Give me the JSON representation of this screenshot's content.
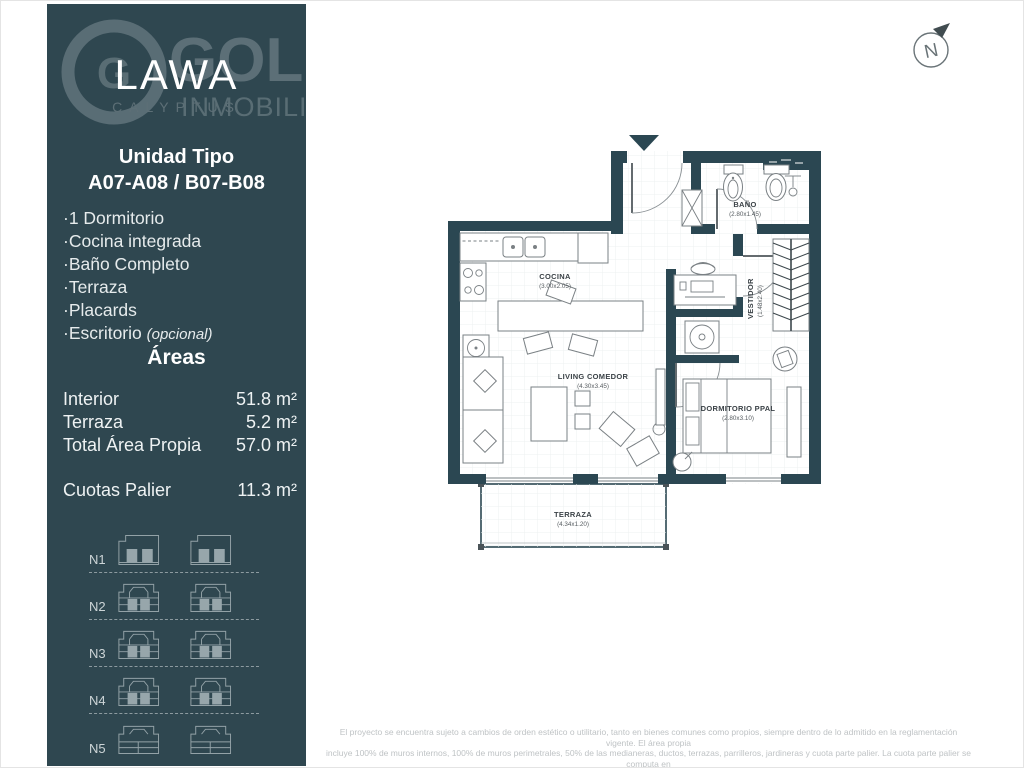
{
  "brand": {
    "logo_main": "LAWA",
    "logo_sub": "CALYPTUS",
    "watermark_initial": "G",
    "watermark_top": "GOLD",
    "watermark_bottom": "INMOBILIARIA"
  },
  "unit": {
    "title_line1": "Unidad Tipo",
    "title_line2": "A07-A08 / B07-B08",
    "features": [
      "·1 Dormitorio",
      "·Cocina integrada",
      "·Baño Completo",
      "·Terraza",
      "·Placards"
    ],
    "feature_optional_name": "·Escritorio ",
    "feature_optional_qualifier": "(opcional)"
  },
  "areas": {
    "heading": "Áreas",
    "rows": [
      {
        "label": "Interior",
        "value": "51.8 m²"
      },
      {
        "label": "Terraza",
        "value": "5.2 m²"
      },
      {
        "label": "Total Área Propia",
        "value": "57.0 m²"
      }
    ],
    "palier": {
      "label": "Cuotas Palier",
      "value": "11.3 m²"
    }
  },
  "levels": {
    "labels": [
      "N1",
      "N2",
      "N3",
      "N4",
      "N5"
    ]
  },
  "floorplan": {
    "north_label": "N",
    "rooms": {
      "cocina": {
        "name": "COCINA",
        "dims": "(3.00x2.05)"
      },
      "bano": {
        "name": "BAÑO",
        "dims": "(2.80x1.45)"
      },
      "vestidor": {
        "name": "VESTIDOR",
        "dims": "(1.48x2.40)"
      },
      "living": {
        "name": "LIVING COMEDOR",
        "dims": "(4.30x3.45)"
      },
      "dormitorio": {
        "name": "DORMITORIO PPAL",
        "dims": "(2.80x3.10)"
      },
      "terraza": {
        "name": "TERRAZA",
        "dims": "(4.34x1.20)"
      }
    }
  },
  "disclaimer": {
    "line1": "El proyecto se encuentra sujeto a cambios de orden estético o utilitario, tanto en bienes comunes como propios, siempre dentro de lo admitido en la reglamentación vigente. El área propia",
    "line2": "incluye 100% de muros internos, 100% de muros perimetrales, 50% de las medianeras, ductos, terrazas, parrilleros, jardineras y cuota parte palier. La cuota parte palier se computa en",
    "line3": "forma proporcional a las áreas de los bienes propios de cada una de las unidades del piso."
  },
  "colors": {
    "sidebar": "#2f4750",
    "wall": "#2b4752",
    "watermark": "#687a81",
    "text_light": "#e6ebec"
  }
}
